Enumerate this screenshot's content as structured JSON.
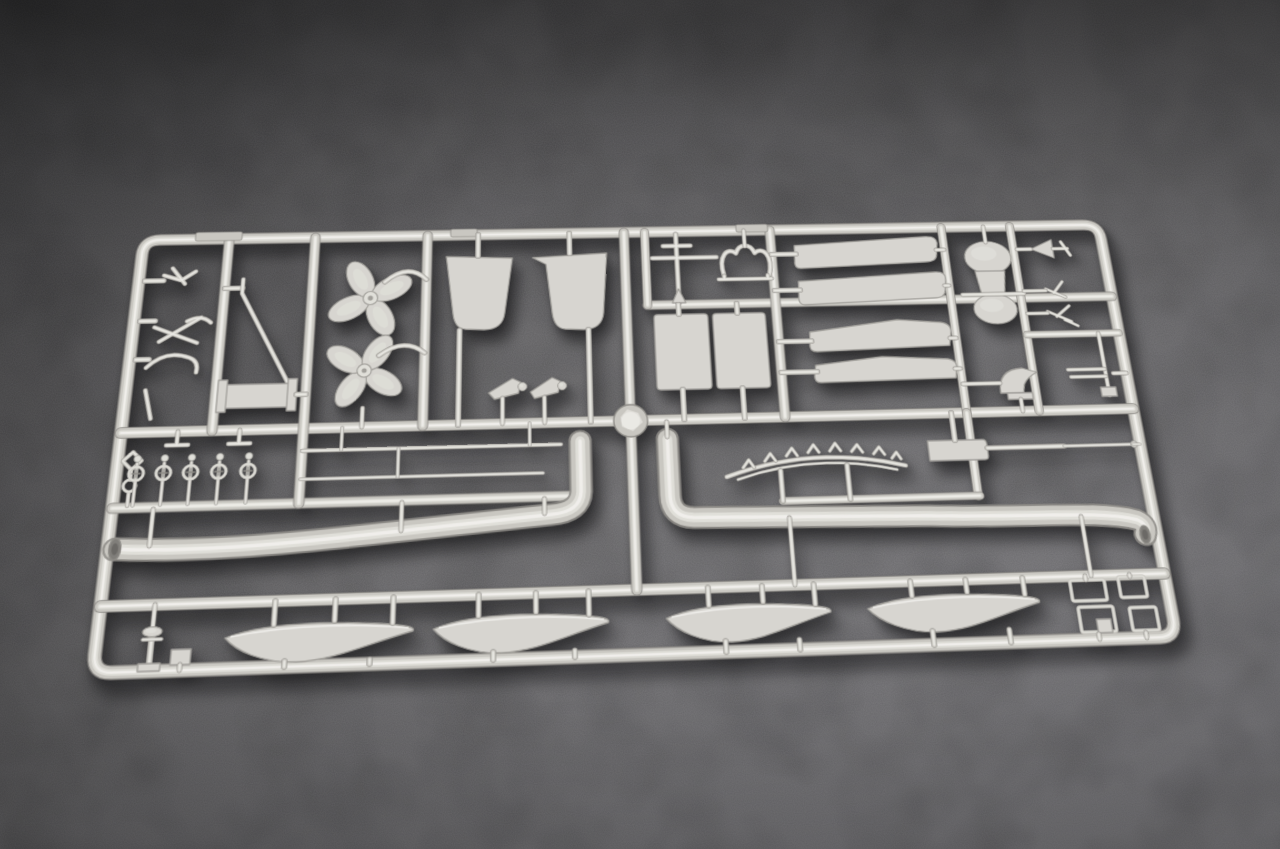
{
  "scene": {
    "type": "photograph",
    "description": "Light grey injection-moulded plastic model kit sprue (parts tree) for a warship model kit, photographed lying on a dark grey speckled stone surface with soft daylight and a soft shadow cast below-right of the plastic frame",
    "background_surface": "dark grey textured stone, darker at top, lighter toward bottom right",
    "lighting": "soft light from upper left"
  },
  "palette": {
    "surface_dark": "#4b4b4d",
    "surface_light": "#828185",
    "plastic_base": "#c9c7c1",
    "plastic_light": "#e0dfd9",
    "plastic_specular": "#f2f1ed",
    "plastic_edge": "#8e8c87",
    "plastic_plate": "#d7d5d0"
  },
  "sprue": {
    "colors": {
      "edge": "#8e8c87",
      "base": "#c9c7c1",
      "light": "#e0dfd9",
      "spec": "#f2f1ed",
      "plate": "#d7d5d0",
      "pedge": "#a19f9a",
      "hole": "#807e7a",
      "holeDark": "#6b6966"
    },
    "parts_inventory": [
      "rectangular sprue frame with runners",
      "two four-bladed propellers",
      "two large rudder plates",
      "two long J-shaped exhaust/uptake pipes with open ends",
      "four ship's boat hulls in bottom row",
      "two rectangular panels",
      "four long tapered hull planks",
      "capstan with two drums",
      "serrated yardarm arc",
      "long cannon barrel with breech block",
      "cable drum with derrick arm",
      "row of five small pulley/stanchion fittings",
      "small anchors and hooks",
      "vent cowl, gun mount, finial cone, small antennas",
      "four small hatch frames",
      "bollard post",
      "central round sprue hub"
    ],
    "elements": [
      {
        "n": "sprue-frame",
        "k": "tube",
        "w": 11,
        "d": "M24 9 H1006 Q1023 9 1023 26 V434 Q1023 451 1006 451 H24 Q7 451 7 434 V26 Q7 9 24 9 Z"
      },
      {
        "n": "runner-mid",
        "k": "tube",
        "w": 10,
        "d": "M7 220 H1023"
      },
      {
        "n": "runner-right-upper",
        "k": "tube",
        "w": 9,
        "d": "M530 94 H1023"
      },
      {
        "n": "runner-left-lower",
        "k": "tube",
        "w": 9,
        "d": "M7 296 H448"
      },
      {
        "n": "runner-bottom",
        "k": "tube",
        "w": 10,
        "d": "M7 390 H1023"
      },
      {
        "n": "runner-v1",
        "k": "tube",
        "w": 9,
        "d": "M95 9 V220"
      },
      {
        "n": "runner-v2",
        "k": "tube",
        "w": 9,
        "d": "M184 9 V296"
      },
      {
        "n": "runner-v3",
        "k": "tube",
        "w": 9,
        "d": "M301 9 V220"
      },
      {
        "n": "runner-v4",
        "k": "tube",
        "w": 9,
        "d": "M508 9 V390"
      },
      {
        "n": "runner-v5",
        "k": "tube",
        "w": 8,
        "d": "M530 9 V94"
      },
      {
        "n": "runner-v6",
        "k": "tube",
        "w": 9,
        "d": "M664 9 V220"
      },
      {
        "n": "runner-v7",
        "k": "tube",
        "w": 8,
        "d": "M850 9 V220"
      },
      {
        "n": "runner-v8",
        "k": "tube",
        "w": 8,
        "d": "M925 9 V220"
      },
      {
        "n": "runner-v9",
        "k": "tube",
        "w": 8,
        "d": "M850 220 V307"
      },
      {
        "n": "runner-serrated-rail",
        "k": "tube",
        "w": 7,
        "d": "M655 307 H852"
      },
      {
        "n": "runner-right-mid",
        "k": "tube",
        "w": 7,
        "d": "M925 136 H1023"
      },
      {
        "n": "ejector-tab-1",
        "k": "tab",
        "x": 60,
        "y": 1,
        "w": 48,
        "h": 10
      },
      {
        "n": "ejector-tab-2",
        "k": "tab",
        "x": 325,
        "y": 2,
        "w": 28,
        "h": 9
      },
      {
        "n": "ejector-tab-3",
        "k": "tab",
        "x": 628,
        "y": 2,
        "w": 34,
        "h": 9
      },
      {
        "n": "exhaust-pipe-left",
        "k": "pipe",
        "w": 19,
        "d": "M14 336 C90 341 170 336 250 329 C330 322 390 317 428 314 Q456 312 457 292 L457 240"
      },
      {
        "n": "pipe-left-gates",
        "k": "rod",
        "w": 4,
        "d": "M46 334 V298 M283 326 V298 M421 313 V298"
      },
      {
        "n": "pipe-left-opening",
        "k": "hole",
        "cx": 14,
        "cy": 336,
        "rx": 5.5,
        "ry": 10.5
      },
      {
        "n": "exhaust-pipe-right",
        "k": "pipe",
        "w": 19,
        "d": "M544 240 V298 Q544 320 566 321 L800 326 C900 331 970 325 1006 336 Q1016 341 1011 351"
      },
      {
        "n": "pipe-right-gates",
        "k": "rod",
        "w": 4,
        "d": "M544 238 V222 M660 324 V390 M950 331 V390"
      },
      {
        "n": "pipe-right-opening",
        "k": "hole",
        "cx": 1011,
        "cy": 351,
        "rx": 5,
        "ry": 9
      },
      {
        "n": "sprue-hub",
        "k": "hub",
        "cx": 508,
        "cy": 220,
        "r": 17
      },
      {
        "n": "anchor-gate-1",
        "k": "rod",
        "w": 5,
        "d": "M13 56 H32"
      },
      {
        "n": "small-anchor-1",
        "k": "rod",
        "w": 4,
        "d": "M32 50 l18 6 l14 -10 M40 42 l14 18"
      },
      {
        "n": "anchor-gate-2",
        "k": "rod",
        "w": 5,
        "d": "M13 101 H28"
      },
      {
        "n": "small-anchor-2",
        "k": "rod",
        "w": 4,
        "d": "M28 108 l44 18 M34 124 l40 -26 M60 102 q14 -8 24 2"
      },
      {
        "n": "hook-gate",
        "k": "rod",
        "w": 5,
        "d": "M13 143 H26"
      },
      {
        "n": "small-hook",
        "k": "rod",
        "w": 4,
        "d": "M24 152 q18 -20 42 -10 q10 4 8 16"
      },
      {
        "n": "small-rod-left",
        "k": "rod",
        "w": 4,
        "d": "M26 176 l8 30"
      },
      {
        "n": "derrick-gate",
        "k": "rod",
        "w": 5,
        "d": "M95 66 H113"
      },
      {
        "n": "derrick-arm",
        "k": "rod",
        "w": 4,
        "d": "M113 56 V72 L166 172"
      },
      {
        "n": "cable-drum",
        "k": "plate",
        "d": "M104 172 H168 V197 H104 Z"
      },
      {
        "n": "cable-drum-flanges",
        "k": "plate",
        "d": "M97 167 h9 v34 h-9 Z M166 167 h9 v34 h-9 Z"
      },
      {
        "n": "drum-gate",
        "k": "rod",
        "w": 5,
        "d": "M175 184 H184"
      },
      {
        "n": "tee-gate-1",
        "k": "rod",
        "w": 4,
        "d": "M62 220 V234 M52 234 H73"
      },
      {
        "n": "tee-gate-2",
        "k": "rod",
        "w": 4,
        "d": "M122 220 V234 M112 234 H133"
      },
      {
        "n": "chain-link",
        "k": "rod",
        "w": 3.5,
        "d": "M21 240 l9 9 l-9 9 l-9 -9 Z M21 258 V268 M21 281 V294"
      },
      {
        "n": "chain-wheel",
        "k": "ring",
        "cx": 21,
        "cy": 274,
        "r": 6,
        "w": 3.2
      },
      {
        "n": "pulley-1",
        "k": "pulley",
        "cx": 26
      },
      {
        "n": "pulley-2",
        "k": "pulley",
        "cx": 52
      },
      {
        "n": "pulley-3",
        "k": "pulley",
        "cx": 78
      },
      {
        "n": "pulley-4",
        "k": "pulley",
        "cx": 105
      },
      {
        "n": "pulley-5",
        "k": "pulley",
        "cx": 133
      },
      {
        "n": "propeller-upper",
        "k": "prop",
        "cx": 244,
        "cy": 80,
        "r": 44,
        "rot": 18
      },
      {
        "n": "propeller-upper-arm",
        "k": "rod",
        "w": 4.5,
        "d": "M258 62 Q282 40 301 60"
      },
      {
        "n": "propeller-lower",
        "k": "prop",
        "cx": 241,
        "cy": 160,
        "r": 42,
        "rot": -12
      },
      {
        "n": "propeller-lower-arm",
        "k": "rod",
        "w": 4.5,
        "d": "M255 144 Q280 124 301 142"
      },
      {
        "n": "propeller-lower-gate",
        "k": "rod",
        "w": 4,
        "d": "M241 200 V220"
      },
      {
        "n": "rudder-left",
        "k": "plate",
        "d": "M321 34 L390 37 L382 100 Q380 118 361 118 L342 117 Q331 116 329 100 L322 42 Z"
      },
      {
        "n": "rudder-left-gate",
        "k": "rod",
        "w": 5,
        "d": "M354 9 V34"
      },
      {
        "n": "rudder-left-post",
        "k": "rod",
        "w": 5,
        "d": "M336 118 V220"
      },
      {
        "n": "rudder-right",
        "k": "plate",
        "d": "M411 37 L489 33 L484 102 Q482 120 463 120 L444 119 Q433 118 431 101 L425 45 Z"
      },
      {
        "n": "rudder-right-gate",
        "k": "rod",
        "w": 5,
        "d": "M450 9 V33"
      },
      {
        "n": "rudder-right-post",
        "k": "rod",
        "w": 5,
        "d": "M468 120 V220"
      },
      {
        "n": "horn-left",
        "k": "plate",
        "d": "M366 187 L390 172 L398 176 L396 188 L372 194 Z"
      },
      {
        "n": "horn-left-knob",
        "k": "disc",
        "cx": 400,
        "cy": 181,
        "r": 4.5
      },
      {
        "n": "horn-left-gate",
        "k": "rod",
        "w": 4,
        "d": "M380 193 V220"
      },
      {
        "n": "horn-right",
        "k": "plate",
        "d": "M408 187 L430 172 L438 176 L436 188 L412 194 Z"
      },
      {
        "n": "horn-right-knob",
        "k": "disc",
        "cx": 440,
        "cy": 181,
        "r": 4.5
      },
      {
        "n": "horn-right-gate",
        "k": "rod",
        "w": 4,
        "d": "M422 193 V220"
      },
      {
        "n": "mast-cross",
        "k": "rod",
        "w": 4.5,
        "d": "M563 12 V92 M537 40 H605 M549 26 H578"
      },
      {
        "n": "mast-cross-foot",
        "k": "plate",
        "d": "M556 92 L563 76 L570 92 Z"
      },
      {
        "n": "wishbone-bracket",
        "k": "rod",
        "w": 4.5,
        "d": "M612 62 C606 38 618 28 626 36 C630 24 642 24 646 36 C654 28 666 38 660 62"
      },
      {
        "n": "wishbone-rail",
        "k": "rod",
        "w": 4,
        "d": "M606 66 H662 M612 62 V66 M658 62 V66 M636 28 V9"
      },
      {
        "n": "panel-left",
        "k": "plate",
        "d": "M540 105 h48 q4 0 4 4 v75 q0 4 -4 4 h-48 q-4 0 -4 -4 v-75 q0 -4 4 -4 Z"
      },
      {
        "n": "panel-left-gates",
        "k": "rod",
        "w": 5,
        "d": "M562 94 V105 M562 188 V220"
      },
      {
        "n": "panel-right",
        "k": "plate",
        "d": "M601 105 h47 q4 0 4 4 v75 q0 4 -4 4 h-47 q-4 0 -4 -4 v-75 q0 -4 4 -4 Z"
      },
      {
        "n": "panel-right-gates",
        "k": "rod",
        "w": 5,
        "d": "M623 94 V105 M623 188 V220"
      },
      {
        "n": "hull-plank-1",
        "k": "plate",
        "d": "M689 28 L830 20 Q845 19 843 30 L841 42 Q840 50 828 50 L694 55 Q687 55 688 47 Z"
      },
      {
        "n": "hull-plank-2",
        "k": "plate",
        "d": "M690 70 L836 62 Q849 61 847 72 L845 84 Q844 92 832 92 L695 97 Q688 97 689 88 Z"
      },
      {
        "n": "hull-plank-3",
        "k": "plate",
        "d": "M697 128 L790 116 L836 120 Q847 122 845 132 L842 146 L703 150 Q695 150 696 142 Z"
      },
      {
        "n": "hull-plank-4",
        "k": "plate",
        "d": "M700 165 L770 157 L838 161 Q848 163 846 172 L844 182 L704 184 Q697 184 698 176 Z"
      },
      {
        "n": "plank-gates-left",
        "k": "rod",
        "w": 5,
        "d": "M664 38 H690 M664 80 H691 M664 138 H698 M664 172 H701"
      },
      {
        "n": "plank-gates-right",
        "k": "rod",
        "w": 4,
        "d": "M841 36 H850 M845 78 H850 M843 138 H850 M844 172 H850"
      },
      {
        "n": "capstan-upper-drum",
        "k": "ellipse",
        "cx": 896,
        "cy": 46,
        "rx": 25,
        "ry": 19
      },
      {
        "n": "capstan-body",
        "k": "plate",
        "d": "M880 62 H912 L908 92 H884 Z"
      },
      {
        "n": "capstan-lower-drum",
        "k": "ellipse",
        "cx": 896,
        "cy": 106,
        "rx": 23,
        "ry": 17
      },
      {
        "n": "capstan-bar",
        "k": "rod",
        "w": 4,
        "d": "M863 89 H929"
      },
      {
        "n": "capstan-gate",
        "k": "rod",
        "w": 4,
        "d": "M896 9 V28"
      },
      {
        "n": "finial-cone",
        "k": "plate",
        "d": "M944 37 L968 26 L968 48 Z"
      },
      {
        "n": "finial-tail",
        "k": "rod",
        "w": 3.5,
        "d": "M968 37 H984 M978 29 l8 16"
      },
      {
        "n": "finial-gate",
        "k": "rod",
        "w": 4,
        "d": "M929 37 H944"
      },
      {
        "n": "antenna-small-1",
        "k": "rod",
        "w": 3,
        "d": "M953 84 l20 10 M961 89 l11 -13"
      },
      {
        "n": "antenna-small-2",
        "k": "rod",
        "w": 3,
        "d": "M951 110 l24 12 M960 116 l15 -12 M968 120 l13 7"
      },
      {
        "n": "antenna-gates",
        "k": "rod",
        "w": 3.5,
        "d": "M929 86 H953 M929 112 H951"
      },
      {
        "n": "vent-cowl",
        "k": "plate",
        "d": "M888 200 Q888 174 914 173 L929 178 Q918 183 914 191 L912 200 Z"
      },
      {
        "n": "vent-cowl-base",
        "k": "plate",
        "d": "M895 200 h26 v7 h-26 Z"
      },
      {
        "n": "vent-cowl-gates",
        "k": "rod",
        "w": 4,
        "d": "M908 207 V220 M850 189 H889"
      },
      {
        "n": "gun-mount-post",
        "k": "rod",
        "w": 4,
        "d": "M1001 162 V205 M1001 162 V136"
      },
      {
        "n": "gun-mount-barrels",
        "k": "rod",
        "w": 3.5,
        "d": "M962 176 H1001 M964 184 H1001"
      },
      {
        "n": "gun-mount-base",
        "k": "plate",
        "d": "M993 196 h16 v10 h-16 Z"
      },
      {
        "n": "gun-mount-gate",
        "k": "rod",
        "w": 4,
        "d": "M1009 181 H1023"
      },
      {
        "n": "yardarm-arc",
        "k": "rod",
        "w": 4,
        "d": "M601 281 Q690 250 781 274"
      },
      {
        "n": "yardarm-teeth",
        "k": "rod",
        "w": 3,
        "d": "M618 272 l6 -8 l5 8 M640 266 l6 -8 l5 8 M662 261 l6 -8 l5 8 M684 258 l6 -8 l5 8 M706 257 l6 -8 l5 8 M728 258 l6 -7 l5 8 M750 261 l6 -7 l5 8 M768 266 l5 -6 l4 7"
      },
      {
        "n": "yardarm-lower-rail",
        "k": "rod",
        "w": 2.5,
        "d": "M612 284 Q690 258 772 278"
      },
      {
        "n": "yardarm-stems",
        "k": "rod",
        "w": 4.5,
        "d": "M655 276 V307 M722 272 V307"
      },
      {
        "n": "cannon-breech",
        "k": "plate",
        "d": "M806 249 h56 q4 0 4 5 v12 q0 4 -4 4 h-56 Z"
      },
      {
        "n": "cannon-barrel",
        "k": "rod",
        "w": 4.5,
        "d": "M866 258 H945"
      },
      {
        "n": "cannon-barrel-tip",
        "k": "rod",
        "w": 3,
        "d": "M945 258 H1016"
      },
      {
        "n": "cannon-muzzle",
        "k": "disc",
        "cx": 1017,
        "cy": 258,
        "r": 3.5
      },
      {
        "n": "cannon-gate",
        "k": "rod",
        "w": 5,
        "d": "M834 249 V220"
      },
      {
        "n": "cannon-rod-gate",
        "k": "rod",
        "w": 2.5,
        "d": "M1016 258 H1023"
      },
      {
        "n": "thin-rod-upper",
        "k": "rod",
        "w": 3.5,
        "d": "M184 243 H438"
      },
      {
        "n": "thin-rod-lower",
        "k": "rod",
        "w": 3,
        "d": "M184 272 H420"
      },
      {
        "n": "thin-rod-gates",
        "k": "rod",
        "w": 3,
        "d": "M222 243 V220 M407 243 V220 M278 272 V243"
      },
      {
        "n": "bollard-gate",
        "k": "rod",
        "w": 4,
        "d": "M57 410 V390"
      },
      {
        "n": "bollard-post",
        "k": "rod",
        "w": 5,
        "d": "M57 416 V446"
      },
      {
        "n": "bollard-cap",
        "k": "ellipse",
        "cx": 57,
        "cy": 415,
        "rx": 9,
        "ry": 4.5
      },
      {
        "n": "bollard-arm",
        "k": "rod",
        "w": 3,
        "d": "M49 422 H66"
      },
      {
        "n": "bollard-base",
        "k": "plate",
        "d": "M47 444 h20 v7 h-20 Z"
      },
      {
        "n": "deck-block",
        "k": "plate",
        "d": "M76 432 h18 v14 h-18 Z"
      },
      {
        "n": "deck-block-gate",
        "k": "rod",
        "w": 4,
        "d": "M85 446 V451"
      },
      {
        "n": "boat-hull-1",
        "k": "hull",
        "x": 124,
        "y": 408,
        "w": 176
      },
      {
        "n": "boat-hull-1-gates",
        "k": "rod",
        "w": 4.5,
        "d": "M168 412 V390 M224 410 V390 M278 414 V390 M180 446 V451 M258 447 V451"
      },
      {
        "n": "boat-hull-2",
        "k": "hull",
        "x": 316,
        "y": 406,
        "w": 167
      },
      {
        "n": "boat-hull-2-gates",
        "k": "rod",
        "w": 4.5,
        "d": "M358 410 V390 M412 408 V390 M462 412 V390 M372 444 V451 M448 445 V451"
      },
      {
        "n": "boat-hull-3",
        "k": "hull",
        "x": 535,
        "y": 403,
        "w": 160
      },
      {
        "n": "boat-hull-3-gates",
        "k": "rod",
        "w": 4.5,
        "d": "M576 407 V390 M628 405 V390 M678 409 V390 M590 441 V451 M660 442 V451"
      },
      {
        "n": "boat-hull-4",
        "k": "hull",
        "x": 728,
        "y": 400,
        "w": 170
      },
      {
        "n": "boat-hull-4-gates",
        "k": "rod",
        "w": 4.5,
        "d": "M772 404 V390 M826 402 V390 M882 406 V390 M788 438 V451 M862 439 V451"
      },
      {
        "n": "hatch-frame-1",
        "k": "orect",
        "x": 928,
        "y": 394,
        "w": 34,
        "h": 20
      },
      {
        "n": "hatch-frame-2",
        "k": "orect",
        "x": 976,
        "y": 392,
        "w": 26,
        "h": 20
      },
      {
        "n": "hatch-frame-3",
        "k": "orect",
        "x": 932,
        "y": 420,
        "w": 34,
        "h": 24
      },
      {
        "n": "hatch-frame-3-block",
        "k": "plate",
        "d": "M948 432 h14 v13 h-14 Z"
      },
      {
        "n": "hatch-frame-4",
        "k": "orect",
        "x": 982,
        "y": 422,
        "w": 26,
        "h": 22
      },
      {
        "n": "hatch-frame-gates",
        "k": "rod",
        "w": 4,
        "d": "M944 394 V390 M988 392 V390 M948 446 V451 M994 446 V451"
      }
    ]
  }
}
